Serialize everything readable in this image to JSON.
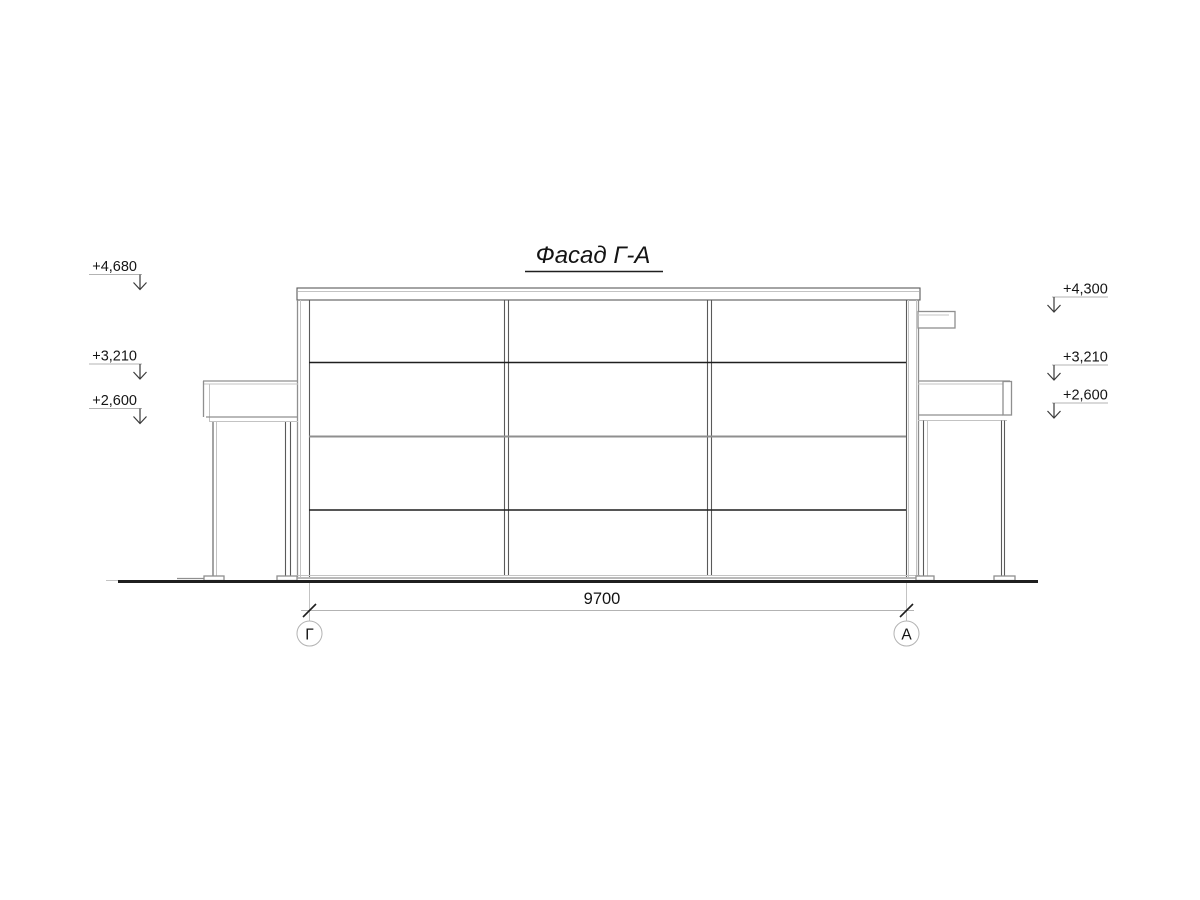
{
  "drawing": {
    "title": "Фасад Г-А",
    "elevation_marks_left": [
      {
        "label": "+4,680"
      },
      {
        "label": "+3,210"
      },
      {
        "label": "+2,600"
      }
    ],
    "elevation_marks_right": [
      {
        "label": "+4,300"
      },
      {
        "label": "+3,210"
      },
      {
        "label": "+2,600"
      }
    ],
    "dimension": {
      "value": "9700"
    },
    "axes": [
      {
        "label": "Г"
      },
      {
        "label": "А"
      }
    ],
    "colors": {
      "line_dark": "#1f1f1f",
      "line_mid": "#5a5a5a",
      "line_gray": "#8f8f8f",
      "line_light": "#c3c3c3",
      "text": "#141414",
      "background": "#ffffff"
    }
  }
}
